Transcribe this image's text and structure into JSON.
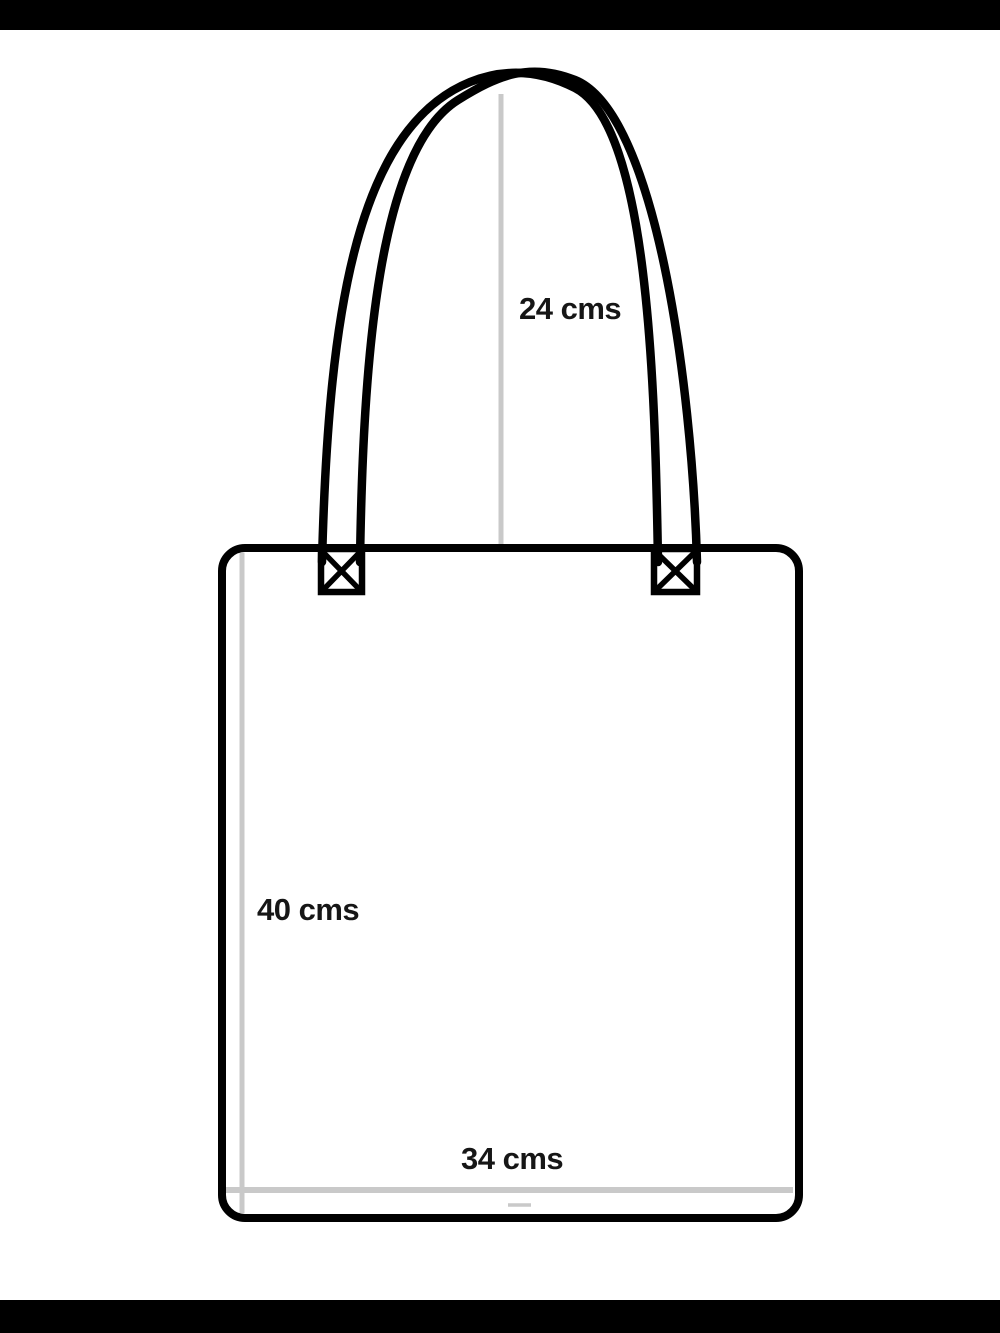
{
  "page": {
    "background_color": "#ffffff"
  },
  "letterbox": {
    "bar_color": "#000000"
  },
  "diagram": {
    "subject": "tote-bag-measurement-diagram",
    "outline_color": "#000000",
    "guide_color": "#c9c9c9",
    "label_color": "#161616",
    "labels": {
      "handle_height": "24 cms",
      "bag_height": "40 cms",
      "bag_width": "34 cms"
    }
  }
}
